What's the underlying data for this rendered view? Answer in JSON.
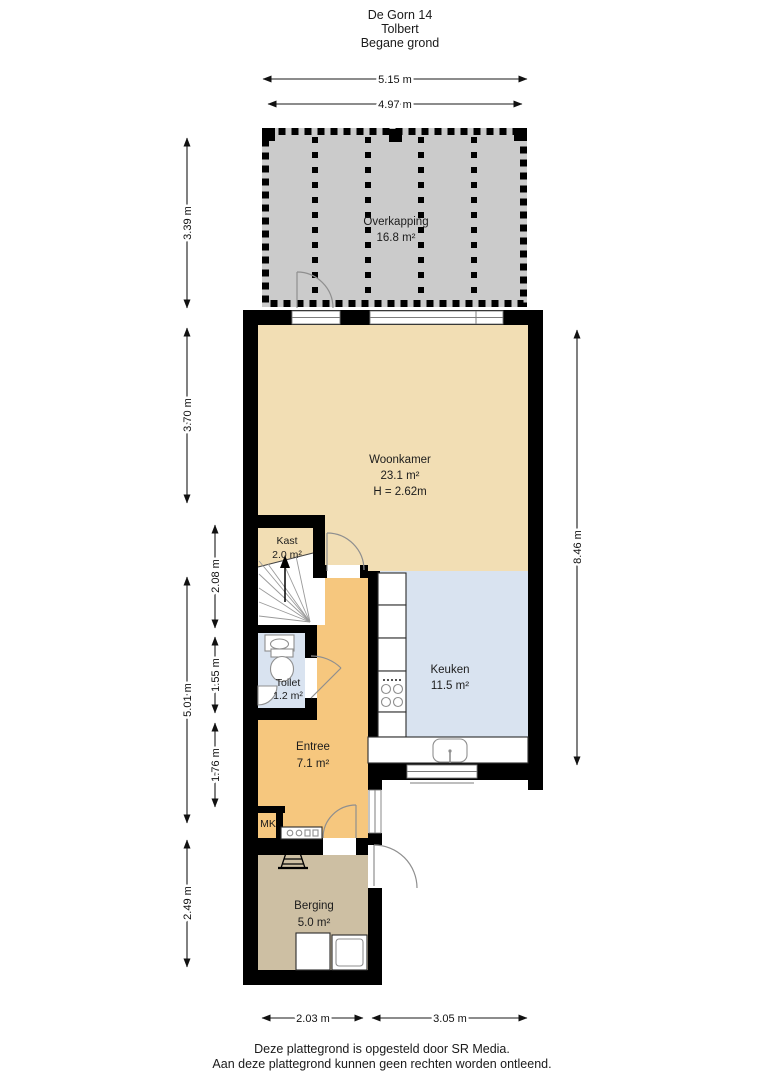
{
  "title": {
    "address": "De Gorn 14",
    "city": "Tolbert",
    "floor": "Begane grond"
  },
  "rooms": {
    "overkapping": {
      "name": "Overkapping",
      "area": "16.8 m²"
    },
    "woonkamer": {
      "name": "Woonkamer",
      "area": "23.1 m²",
      "ceiling": "H = 2.62m"
    },
    "kast": {
      "name": "Kast",
      "area": "2.0 m²"
    },
    "toilet": {
      "name": "Toilet",
      "area": "1.2 m²"
    },
    "entree": {
      "name": "Entree",
      "area": "7.1 m²"
    },
    "keuken": {
      "name": "Keuken",
      "area": "11.5 m²"
    },
    "mk": {
      "name": "MK"
    },
    "berging": {
      "name": "Berging",
      "area": "5.0 m²"
    }
  },
  "dimensions": {
    "canopy_width_outer": "5.15 m",
    "canopy_width_inner": "4.97 m",
    "canopy_depth": "3.39 m",
    "woonkamer_depth": "3.70 m",
    "lower_left_total": "5.01 m",
    "kast_stairs": "2.08 m",
    "toilet_depth": "1.55 m",
    "entree_depth": "1.76 m",
    "berging_depth": "2.49 m",
    "interior_height_right": "8.46 m",
    "bottom_left_width": "2.03 m",
    "bottom_right_width": "3.05 m"
  },
  "footer": {
    "line1": "Deze plattegrond is opgesteld door SR Media.",
    "line2": "Aan deze plattegrond kunnen geen rechten worden ontleend."
  },
  "colors": {
    "wall": "#000000",
    "woonkamer": "#f2deb4",
    "kast": "#f2deb4",
    "entree": "#f6c77e",
    "keuken": "#d9e3f0",
    "toilet": "#d9e3f0",
    "berging": "#cdbfa3",
    "overkapping": "#cbcbcb"
  }
}
